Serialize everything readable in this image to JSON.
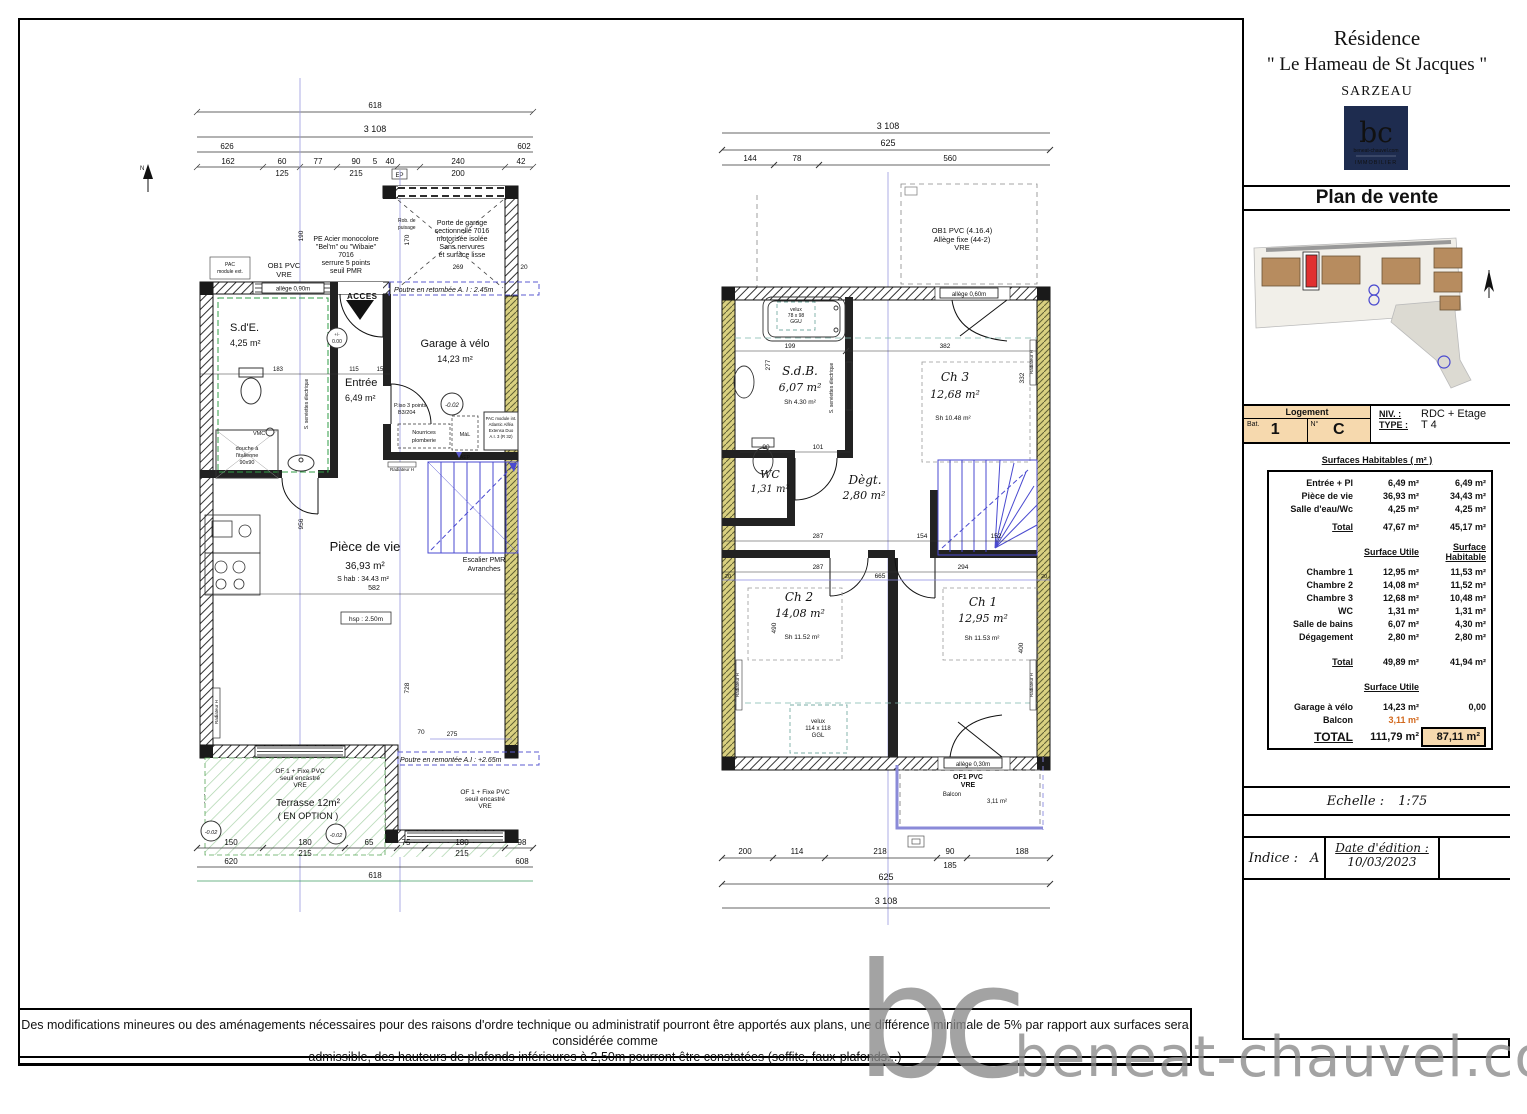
{
  "header": {
    "residence": "Résidence",
    "name": "\" Le Hameau de St Jacques \"",
    "city": "SARZEAU"
  },
  "logo": {
    "initials": "bc",
    "site": "beneat-chauvel.com",
    "tagline": "IMMOBILIER"
  },
  "plan_title": "Plan de vente",
  "logement": {
    "header": "Logement",
    "bat_label": "Bat.",
    "bat_value": "1",
    "num_label": "N°",
    "num_value": "C",
    "niv_label": "NIV. :",
    "niv_value": "RDC + Etage",
    "type_label": "TYPE :",
    "type_value": "T 4"
  },
  "surfaces": {
    "title": "Surfaces Habitables ( m² )",
    "col_utile": "Surface Utile",
    "col_habitable": "Surface Habitable",
    "rows_rdc": [
      {
        "label": "Entrée + Pl",
        "u": "6,49 m²",
        "h": "6,49 m²"
      },
      {
        "label": "Pièce de vie",
        "u": "36,93 m²",
        "h": "34,43 m²"
      },
      {
        "label": "Salle d'eau/Wc",
        "u": "4,25 m²",
        "h": "4,25 m²"
      }
    ],
    "total_rdc": {
      "label": "Total",
      "u": "47,67 m²",
      "h": "45,17 m²"
    },
    "rows_etage": [
      {
        "label": "Chambre 1",
        "u": "12,95 m²",
        "h": "11,53 m²"
      },
      {
        "label": "Chambre 2",
        "u": "14,08 m²",
        "h": "11,52 m²"
      },
      {
        "label": "Chambre 3",
        "u": "12,68 m²",
        "h": "10,48 m²"
      },
      {
        "label": "WC",
        "u": "1,31 m²",
        "h": "1,31 m²"
      },
      {
        "label": "Salle de bains",
        "u": "6,07 m²",
        "h": "4,30 m²"
      },
      {
        "label": "Dégagement",
        "u": "2,80 m²",
        "h": "2,80 m²"
      }
    ],
    "total_etage": {
      "label": "Total",
      "u": "49,89 m²",
      "h": "41,94 m²"
    },
    "col_utile2": "Surface Utile",
    "garage": {
      "label": "Garage à vélo",
      "u": "14,23 m²",
      "h": "0,00"
    },
    "balcon": {
      "label": "Balcon",
      "u": "3,11 m²"
    },
    "grand": {
      "label": "TOTAL",
      "u": "111,79 m²",
      "h": "87,11 m²"
    }
  },
  "tb": {
    "echelle_label": "Echelle :",
    "echelle_value": "1:75",
    "indice_label": "Indice :",
    "indice_value": "A",
    "date_label": "Date d'édition :",
    "date_value": "10/03/2023"
  },
  "disclaimer": {
    "line1": "Des modifications mineures ou des aménagements nécessaires pour des raisons d'ordre technique ou administratif pourront être apportés aux plans, une différence minimale de 5% par rapport aux surfaces sera considérée comme",
    "line2": "admissible, des hauteurs de plafonds inférieures à 2,50m pourront être constatées (soffite, faux-plafonds...)"
  },
  "watermark": {
    "initials": "bc",
    "text": "beneat-chauvel.com"
  },
  "rdc": {
    "north": "N",
    "d618": "618",
    "d3108": "3 108",
    "d626": "626",
    "d602": "602",
    "dims_row1": [
      "162",
      "60",
      "77",
      "90",
      "5",
      "40",
      "240",
      "42"
    ],
    "dims_row2": [
      "125",
      "215",
      "200"
    ],
    "ep": "EP",
    "porte_garage": [
      "Porte de garage",
      "sectionnelle 7016",
      "motorisée isolée",
      "Sans nervures",
      "et surface lisse"
    ],
    "rob_puisage": [
      "Rob. de",
      "puisage"
    ],
    "pe_acier": [
      "PE Acier monocolore",
      "\"Bel'm\" ou \"Wibaie\"",
      "7016",
      "serrure 5 points",
      "seuil PMR"
    ],
    "pac_ext": [
      "PAC",
      "module ext."
    ],
    "ob1": [
      "OB1 PVC",
      "VRE"
    ],
    "allege090": "allège 0,90m",
    "acces": "ACCES",
    "poutre_retombee": "Poutre en retombée A. I : 2.45m",
    "level_zero": [
      "+/-",
      "0.00"
    ],
    "level_m002": "-0.02",
    "sde_name": "S.d'E.",
    "sde_area": "4,25 m²",
    "vmc": "VMC",
    "douche": [
      "douche à",
      "l'italienne",
      "90x90"
    ],
    "seche_serviettes": "S. serviettes électrique",
    "entree_name": "Entrée",
    "entree_area": "6,49 m²",
    "piso": [
      "P.iso 3 points",
      "B3/204"
    ],
    "garage_name": "Garage à vélo",
    "garage_area": "14,23 m²",
    "nourrices": [
      "Nourrices",
      "plomberie"
    ],
    "mal": "MàL",
    "aep": "AEP",
    "pac_int": [
      "PAC module int.",
      "Atlantic Alféa",
      "Extensa Duo",
      "A.I. 3 (R 32)"
    ],
    "radiateur": "Radiateur H",
    "piece_name": "Pièce de vie",
    "piece_area": "36,93 m²",
    "piece_shab": "S hab : 34.43 m²",
    "hsp": "hsp : 2.50m",
    "escalier": [
      "Escalier PMR",
      "Avranches"
    ],
    "of1": [
      "OF 1 + Fixe PVC",
      "seuil encastré",
      "VRE"
    ],
    "terrasse_name": "Terrasse 12m²",
    "terrasse_option": "( EN OPTION )",
    "poutre_remontee": "Poutre en remontée A.I : +2.65m",
    "dims_374": [
      "183",
      "115",
      "15"
    ],
    "d582": "582",
    "dims_blue": {
      "a269": "269",
      "a20": "20",
      "a275": "275",
      "a70": "70",
      "a170": "170",
      "a190": "190",
      "a956": "956",
      "a728": "728",
      "a267": "267"
    },
    "dims_b1": [
      "150",
      "180",
      "65",
      "75",
      "180",
      "98"
    ],
    "dims_b2": [
      "215",
      "215"
    ],
    "dims_b3": [
      "620",
      "608"
    ],
    "dims_b4": "618"
  },
  "etage": {
    "d3108": "3 108",
    "d625": "625",
    "dims_row1": [
      "144",
      "78",
      "560"
    ],
    "ob1": [
      "OB1 PVC (4.16.4)",
      "Allège fixe (44-2)",
      "VRE"
    ],
    "allege060": "allège 0,60m",
    "velux1": [
      "velux",
      "78 x 98",
      "GGU"
    ],
    "sdb_name": "S.d.B.",
    "sdb_area": "6,07 m²",
    "sdb_sh": "Sh 4.30 m²",
    "seche_serviettes": "S. serviettes électrique",
    "ch3_name": "Ch 3",
    "ch3_area": "12,68 m²",
    "ch3_sh": "Sh 10.48 m²",
    "wc_name": "WC",
    "wc_area": "1,31 m²",
    "degt_name": "Dègt.",
    "degt_area": "2,80 m²",
    "ch2_name": "Ch 2",
    "ch2_area": "14,08 m²",
    "ch2_sh": "Sh 11.52 m²",
    "ch1_name": "Ch 1",
    "ch1_area": "12,95 m²",
    "ch1_sh": "Sh 11.53 m²",
    "velux2": [
      "velux",
      "114 x 118",
      "GGL"
    ],
    "allege030": "allège 0,30m",
    "of1": [
      "OF1 PVC",
      "VRE"
    ],
    "balcon_name": "Balcon",
    "balcon_area": "3,11 m²",
    "radiateur": "Radiateur H",
    "d199": "199",
    "d382": "382",
    "dims_90101": [
      "90",
      "101"
    ],
    "dims_mid": [
      "287",
      "154",
      "152"
    ],
    "dims_mid2": [
      "287",
      "294"
    ],
    "d665": "665",
    "d20": "20",
    "d277": "277",
    "d332": "332",
    "d490": "490",
    "d400": "400",
    "dims_b1": [
      "200",
      "114",
      "218",
      "90",
      "188"
    ],
    "d185": "185",
    "d625b": "625",
    "d3108b": "3 108"
  }
}
